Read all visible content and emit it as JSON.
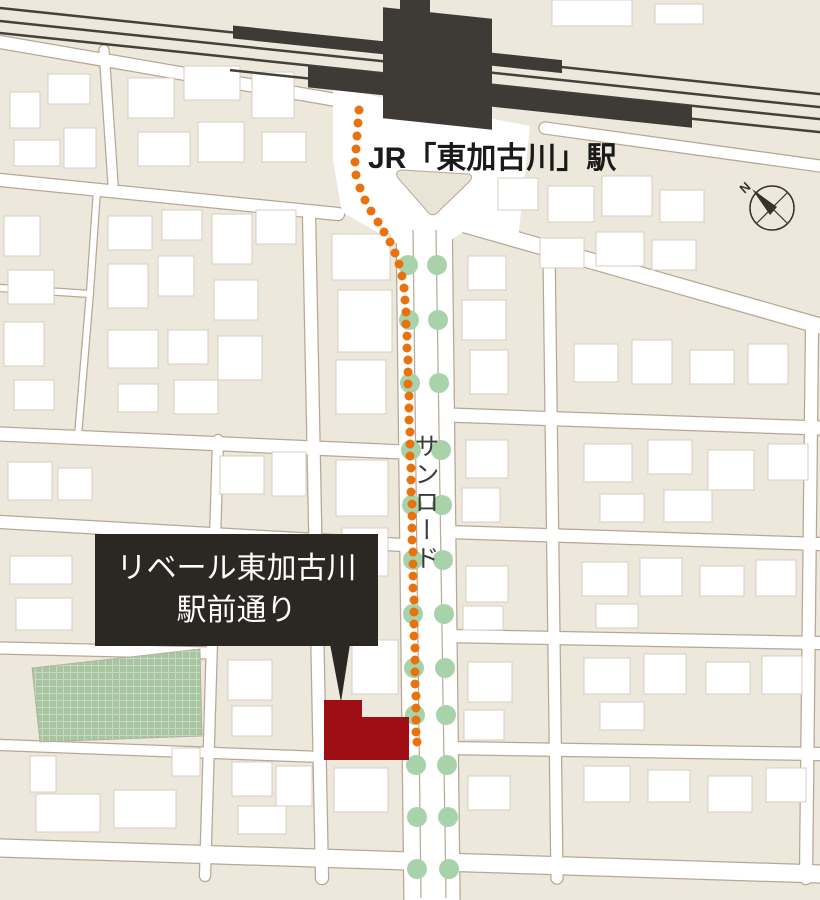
{
  "map": {
    "background_color": "#ece8db",
    "road_fill": "#ffffff",
    "road_outline": "#b9a795",
    "building_fill": "#ffffff",
    "building_outline": "#d8cec0"
  },
  "station": {
    "label": "JR「東加古川」駅",
    "label_color": "#1a1a1a",
    "shape_color": "#3e3a35",
    "rail_line_color": "#44403a"
  },
  "plaza": {
    "island_fill": "#e9e4d5"
  },
  "route": {
    "description": "walking-route-dotted-line",
    "color": "#e9720e",
    "dot_radius": 4.5,
    "dots": [
      [
        359,
        110
      ],
      [
        358,
        123
      ],
      [
        357,
        136
      ],
      [
        356,
        149
      ],
      [
        355,
        162
      ],
      [
        356,
        175
      ],
      [
        360,
        188
      ],
      [
        365,
        200
      ],
      [
        371,
        211
      ],
      [
        378,
        222
      ],
      [
        384,
        232
      ],
      [
        390,
        242
      ],
      [
        395,
        253
      ],
      [
        399,
        264
      ],
      [
        402,
        276
      ],
      [
        404,
        288
      ],
      [
        405,
        300
      ],
      [
        406,
        312
      ],
      [
        406,
        324
      ],
      [
        407,
        336
      ],
      [
        407,
        348
      ],
      [
        408,
        360
      ],
      [
        408,
        372
      ],
      [
        408,
        384
      ],
      [
        409,
        396
      ],
      [
        409,
        408
      ],
      [
        409,
        420
      ],
      [
        410,
        432
      ],
      [
        410,
        444
      ],
      [
        410,
        456
      ],
      [
        411,
        468
      ],
      [
        411,
        480
      ],
      [
        411,
        492
      ],
      [
        412,
        504
      ],
      [
        412,
        516
      ],
      [
        412,
        528
      ],
      [
        412,
        540
      ],
      [
        413,
        552
      ],
      [
        413,
        564
      ],
      [
        413,
        576
      ],
      [
        413,
        588
      ],
      [
        414,
        600
      ],
      [
        414,
        612
      ],
      [
        414,
        624
      ],
      [
        414,
        636
      ],
      [
        415,
        648
      ],
      [
        415,
        660
      ],
      [
        415,
        672
      ],
      [
        415,
        684
      ],
      [
        416,
        696
      ],
      [
        416,
        708
      ],
      [
        416,
        720
      ],
      [
        416,
        732
      ],
      [
        417,
        742
      ]
    ]
  },
  "trees": {
    "description": "street-trees-along-sunroad",
    "color": "#a8d3aa",
    "dot_radius": 10,
    "dots": [
      [
        408,
        265
      ],
      [
        437,
        265
      ],
      [
        409,
        320
      ],
      [
        438,
        320
      ],
      [
        410,
        383
      ],
      [
        439,
        383
      ],
      [
        411,
        450
      ],
      [
        441,
        450
      ],
      [
        412,
        505
      ],
      [
        442,
        505
      ],
      [
        413,
        560
      ],
      [
        443,
        560
      ],
      [
        413,
        614
      ],
      [
        444,
        614
      ],
      [
        414,
        668
      ],
      [
        445,
        668
      ],
      [
        415,
        715
      ],
      [
        446,
        715
      ],
      [
        416,
        765
      ],
      [
        447,
        765
      ],
      [
        417,
        817
      ],
      [
        448,
        817
      ],
      [
        417,
        869
      ],
      [
        449,
        869
      ]
    ]
  },
  "road_label": {
    "text": "サンロード",
    "color": "#3b3b3b"
  },
  "property": {
    "label_line1": "リベール東加古川",
    "label_line2": "駅前通り",
    "box_color": "#2b2722",
    "text_color": "#ffffff",
    "building_color": "#a00e15"
  },
  "park": {
    "fill": "#a8c5a2",
    "grid_color": "#c6d8bf"
  },
  "compass": {
    "label": "N",
    "color": "#35312b"
  }
}
